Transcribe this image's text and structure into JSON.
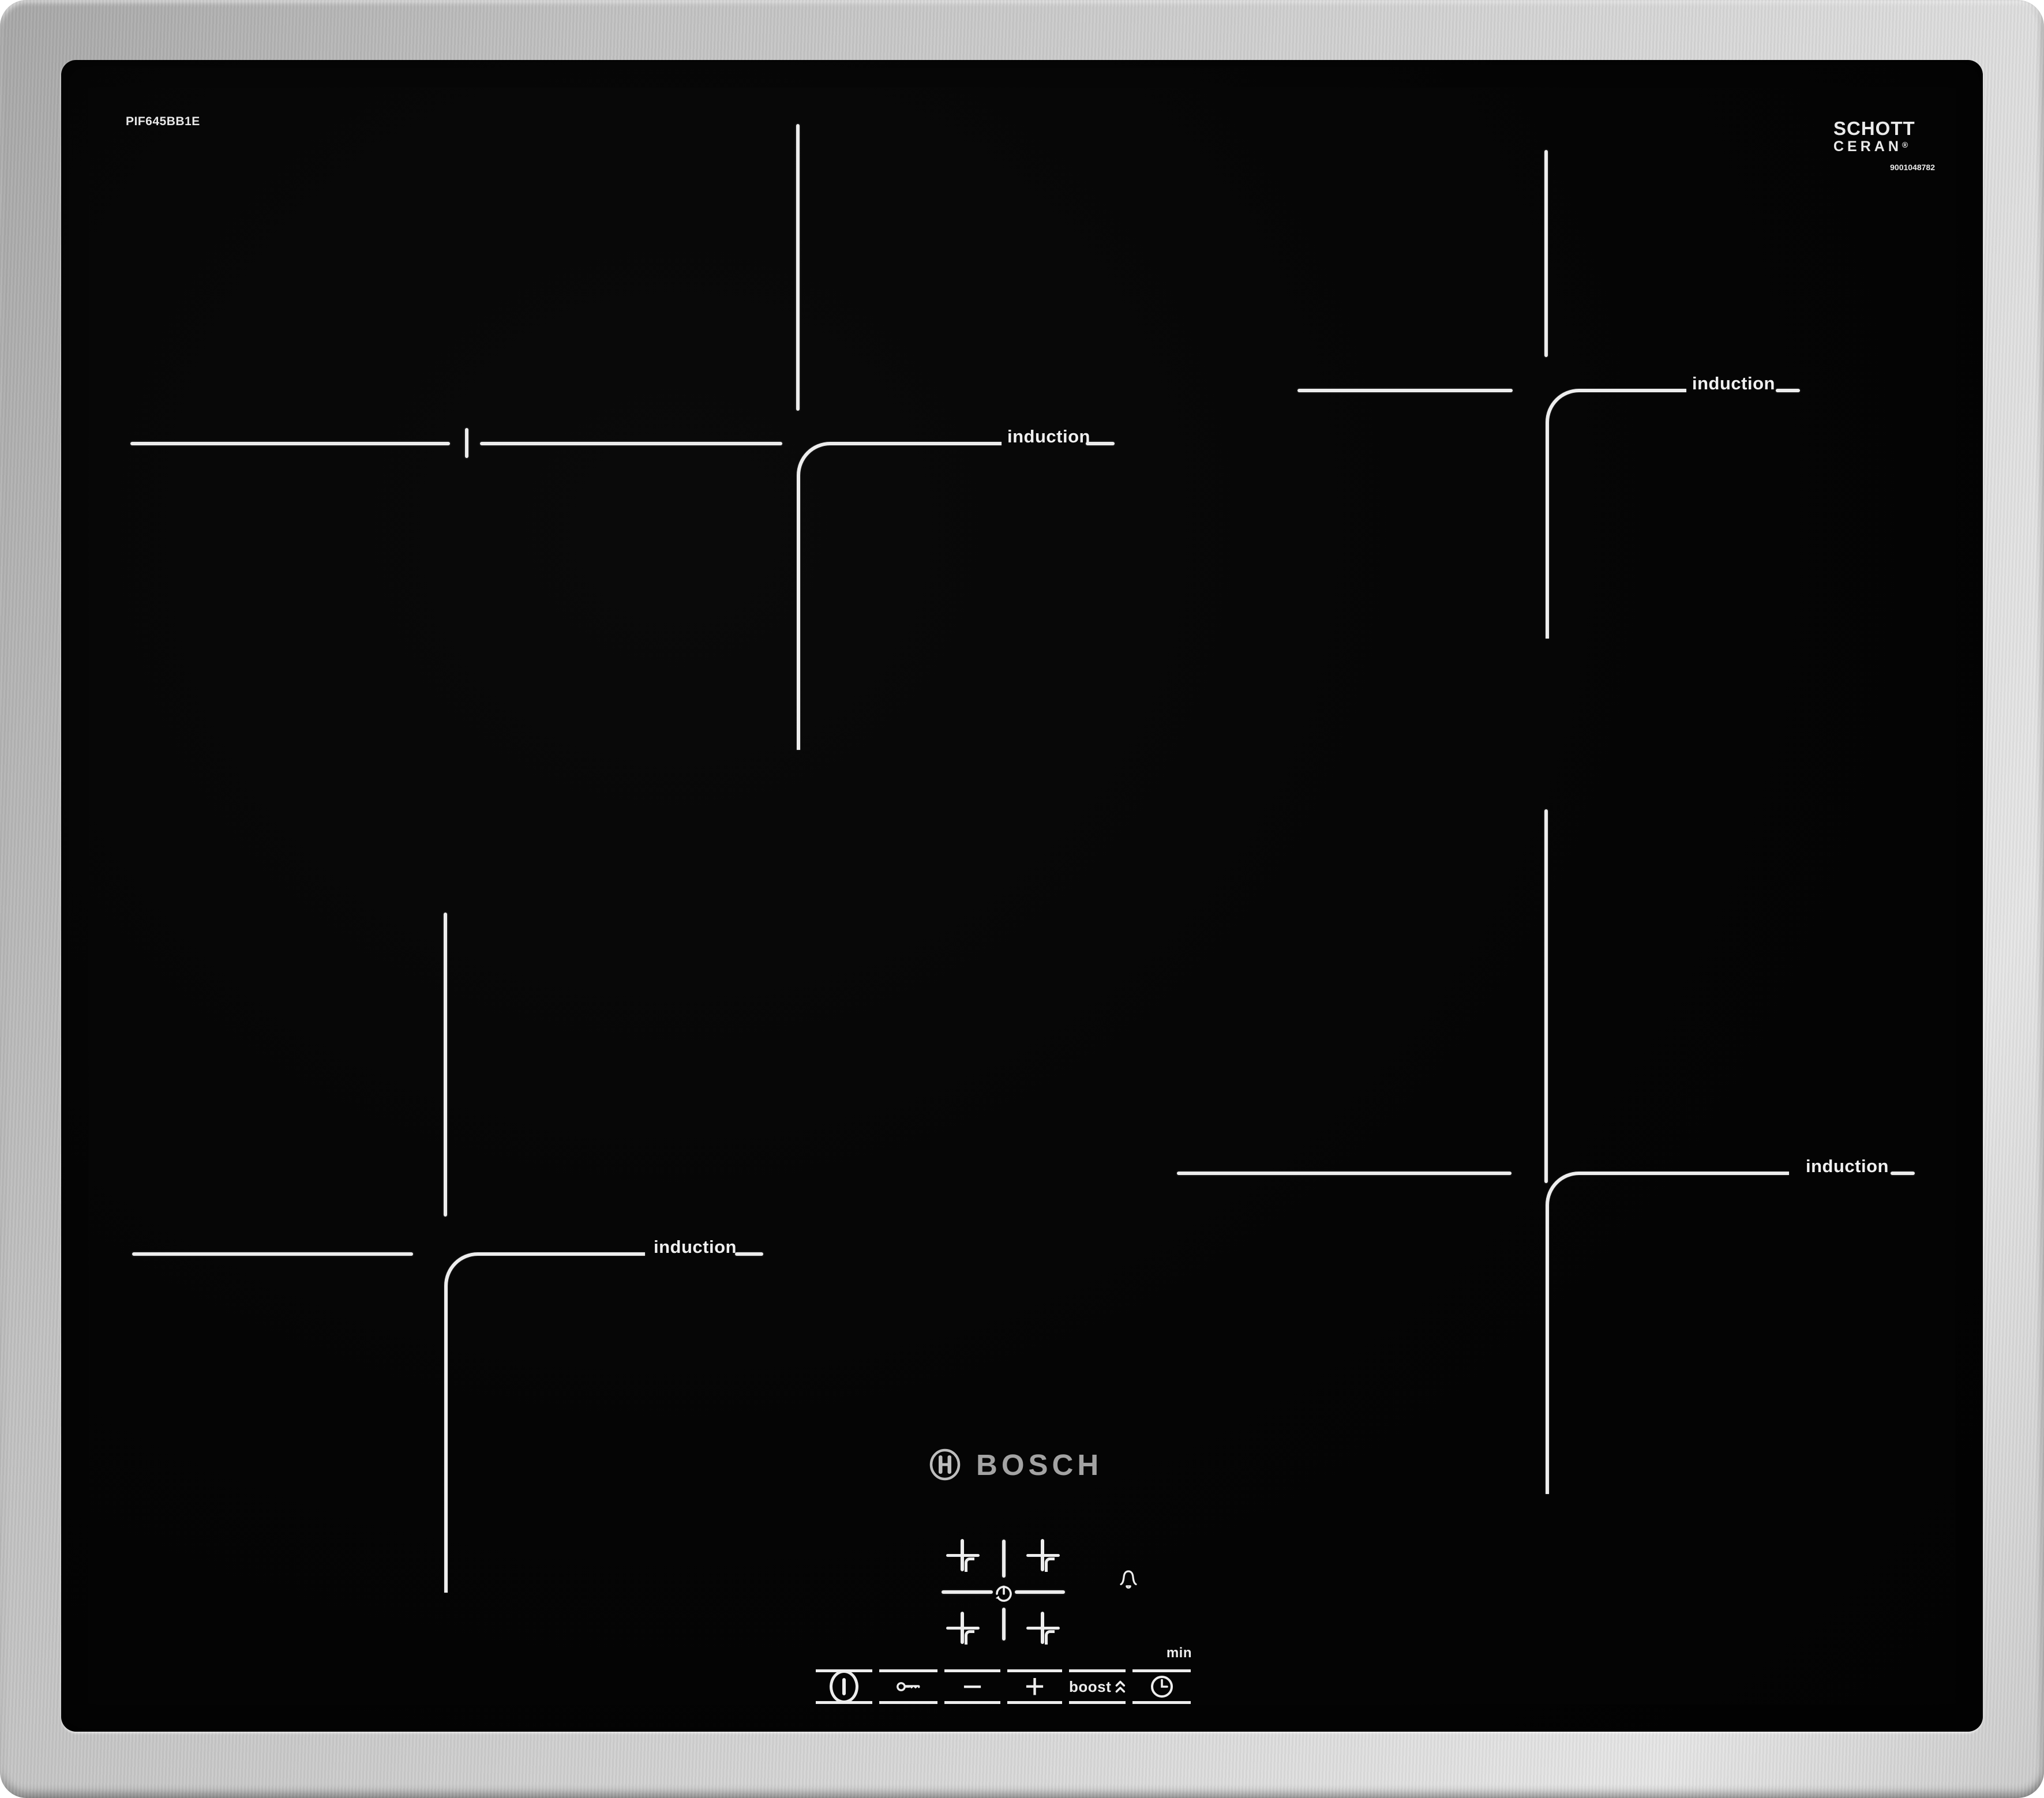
{
  "colors": {
    "zone_mark": "#ededed",
    "frame_steel": "#cccccc",
    "glass_black": "#060606",
    "bosch_text_gray": "#a3a3a3"
  },
  "labels": {
    "model_number": "PIF645BB1E",
    "print_number": "9001048782",
    "glass_brand_line1": "SCHOTT",
    "glass_brand_line2": "CERAN",
    "registered_mark": "®",
    "manufacturer_wordmark": "BOSCH"
  },
  "zones": {
    "items": [
      {
        "position": "top-left",
        "label": "induction"
      },
      {
        "position": "top-right",
        "label": "induction"
      },
      {
        "position": "bottom-left",
        "label": "induction"
      },
      {
        "position": "bottom-right",
        "label": "induction"
      }
    ]
  },
  "controls": {
    "power": {
      "icon": "power-icon"
    },
    "child_lock": {
      "icon": "key-icon"
    },
    "decrease": {
      "label": "−"
    },
    "increase": {
      "label": "+"
    },
    "boost": {
      "label": "boost",
      "icon": "double-chevron-up-icon"
    },
    "timer": {
      "icon": "clock-icon",
      "unit_label": "min",
      "alarm_icon": "bell-icon",
      "zone_select_icon": "rotate-timer-icon"
    }
  }
}
